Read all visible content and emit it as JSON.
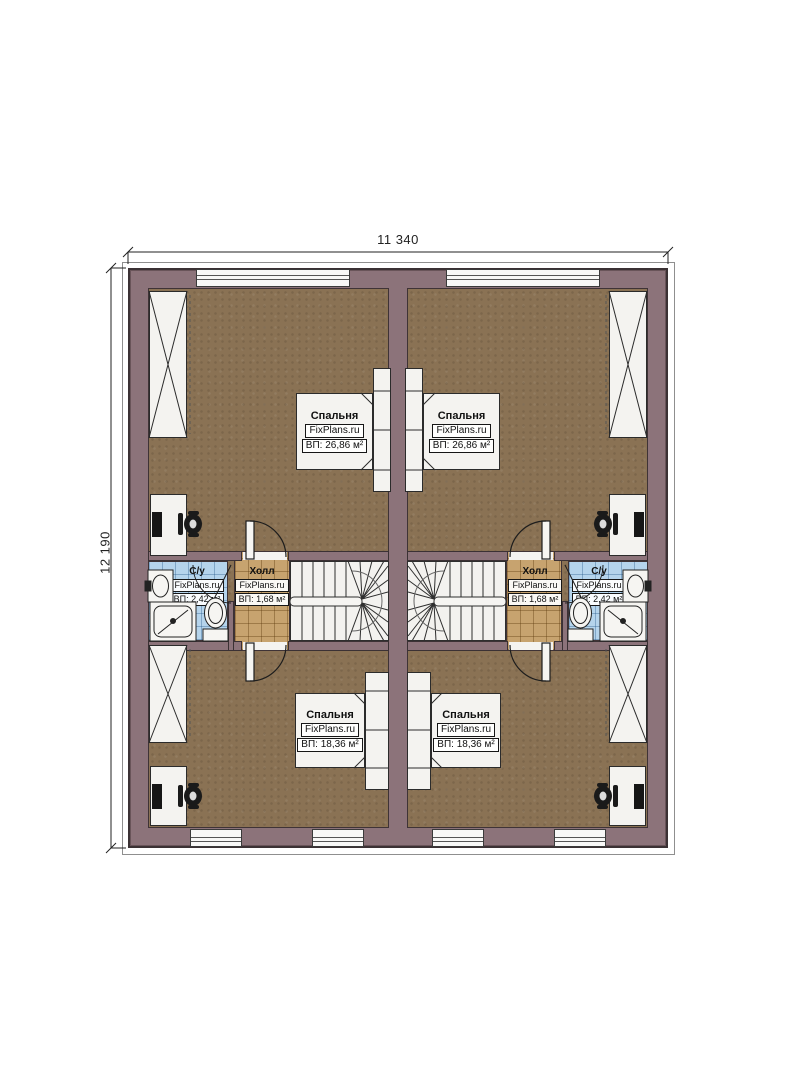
{
  "title": "Floor plan — duplex upper level",
  "dimensions": {
    "width_label": "11 340",
    "height_label": "12 190"
  },
  "colors": {
    "wall": "#8c737a",
    "floor": "#8a7254",
    "hall_tile": "#c7a36f",
    "bath_tile": "#b5d4ec",
    "furniture": "#f4f3f0",
    "line": "#2b2b2b"
  },
  "units": [
    {
      "id": "left",
      "rooms": {
        "bedroom_top": {
          "name": "Спальня",
          "brand": "FixPlans.ru",
          "area": "ВП: 26,86 м²"
        },
        "bedroom_bottom": {
          "name": "Спальня",
          "brand": "FixPlans.ru",
          "area": "ВП: 18,36 м²"
        },
        "hall": {
          "name": "Холл",
          "brand": "FixPlans.ru",
          "area": "ВП: 1,68 м²"
        },
        "bathroom": {
          "name": "С/у",
          "brand": "FixPlans.ru",
          "area": "ВП: 2,42 м²"
        }
      }
    },
    {
      "id": "right",
      "rooms": {
        "bedroom_top": {
          "name": "Спальня",
          "brand": "FixPlans.ru",
          "area": "ВП: 26,86 м²"
        },
        "bedroom_bottom": {
          "name": "Спальня",
          "brand": "FixPlans.ru",
          "area": "ВП: 18,36 м²"
        },
        "hall": {
          "name": "Холл",
          "brand": "FixPlans.ru",
          "area": "ВП: 1,68 м²"
        },
        "bathroom": {
          "name": "С/у",
          "brand": "FixPlans.ru",
          "area": "ВП: 2,42 м²"
        }
      }
    }
  ]
}
